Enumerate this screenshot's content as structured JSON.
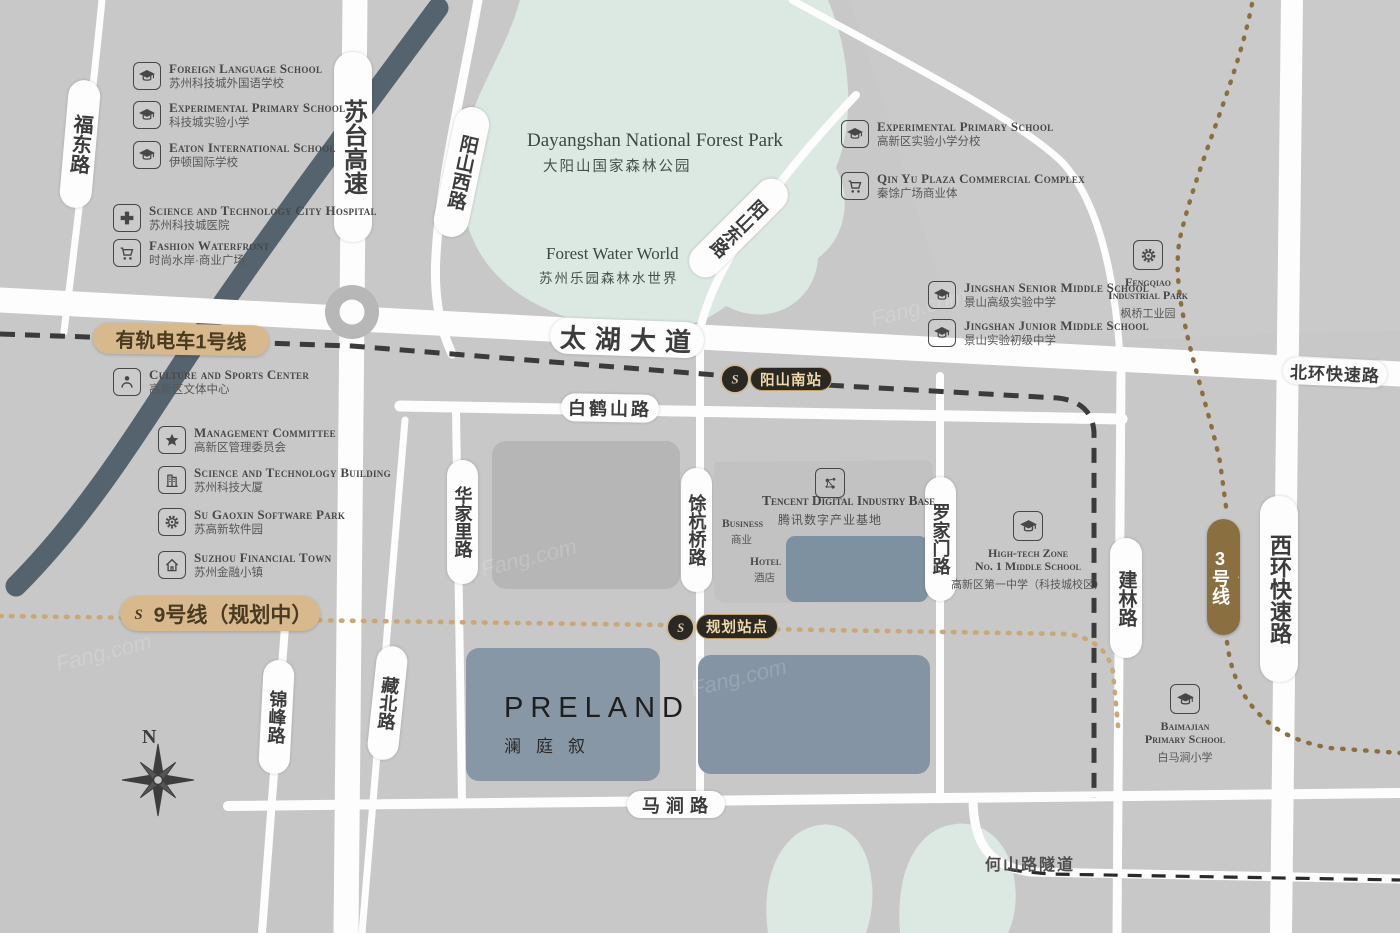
{
  "watermark": "Fang.com",
  "compass": {
    "north": "N"
  },
  "colors": {
    "background": "#c8c8c8",
    "park_green": "#dcE8e2",
    "accent_tan": "#d8b98d",
    "accent_brown": "#8a7040",
    "badge_dark": "#2b2723",
    "site_slate": "#8897a6",
    "highway_dark": "#55636f"
  },
  "park": {
    "name_en": "Dayangshan National Forest Park",
    "name_cn": "大阳山国家森林公园",
    "water_world_en": "Forest Water World",
    "water_world_cn": "苏州乐园森林水世界"
  },
  "project": {
    "name": "PRELAND",
    "name_cn": "澜庭叙"
  },
  "roads": {
    "fudong": "福东路",
    "sutai": "苏台高速",
    "yangshan_west": "阳山西路",
    "yangshan_east": "阳山东路",
    "taihu": "太湖大道",
    "baihe": "白鹤山路",
    "beihuan": "北环快速路",
    "huajiali": "华家里路",
    "yuhangqiao": "馀杭桥路",
    "luojiamen": "罗家门路",
    "jianlin": "建林路",
    "xihuan": "西环快速路",
    "jinfeng": "锦峰路",
    "zangbei": "藏北路",
    "majian": "马涧路",
    "heshan_tunnel": "何山路隧道"
  },
  "transit": {
    "tram_line1": "有轨电车1号线",
    "line9": "9号线（规划中）",
    "line3": "3号线",
    "station_yangshan_south": "阳山南站",
    "station_planned": "规划站点"
  },
  "tencent": {
    "en": "Tencent Digital Industry Base",
    "cn": "腾讯数字产业基地",
    "business_en": "Business",
    "business_cn": "商业",
    "hotel_en": "Hotel",
    "hotel_cn": "酒店"
  },
  "pois": [
    {
      "icon": "graduation-cap",
      "en": "Foreign Language School",
      "cn": "苏州科技城外国语学校"
    },
    {
      "icon": "graduation-cap",
      "en": "Experimental Primary School",
      "cn": "科技城实验小学"
    },
    {
      "icon": "graduation-cap",
      "en": "Eaton International School",
      "cn": "伊顿国际学校"
    },
    {
      "icon": "medical-cross",
      "en": "Science and Technology City Hospital",
      "cn": "苏州科技城医院"
    },
    {
      "icon": "shopping-cart",
      "en": "Fashion Waterfront",
      "cn": "时尚水岸·商业广场"
    },
    {
      "icon": "person",
      "en": "Culture and Sports Center",
      "cn": "高新区文体中心"
    },
    {
      "icon": "star",
      "en": "Management Committee",
      "cn": "高新区管理委员会"
    },
    {
      "icon": "building",
      "en": "Science and Technology Building",
      "cn": "苏州科技大厦"
    },
    {
      "icon": "gear",
      "en": "Su Gaoxin Software Park",
      "cn": "苏高新软件园"
    },
    {
      "icon": "house",
      "en": "Suzhou Financial Town",
      "cn": "苏州金融小镇"
    },
    {
      "icon": "graduation-cap",
      "en": "Experimental Primary School",
      "cn": "高新区实验小学分校"
    },
    {
      "icon": "shopping-cart",
      "en": "Qin Yu Plaza Commercial Complex",
      "cn": "秦馀广场商业体"
    },
    {
      "icon": "graduation-cap",
      "en": "Jingshan Senior Middle School",
      "cn": "景山高级实验中学"
    },
    {
      "icon": "graduation-cap",
      "en": "Jingshan Junior Middle School",
      "cn": "景山实验初级中学"
    },
    {
      "icon": "gear",
      "en": "Fengqiao\nIndustrial Park",
      "cn": "枫桥工业园"
    },
    {
      "icon": "graduation-cap",
      "en": "High-tech Zone\nNo. 1 Middle School",
      "cn": "高新区第一中学（科技城校区）"
    },
    {
      "icon": "graduation-cap",
      "en": "Baimajian\nPrimary School",
      "cn": "白马涧小学"
    }
  ]
}
